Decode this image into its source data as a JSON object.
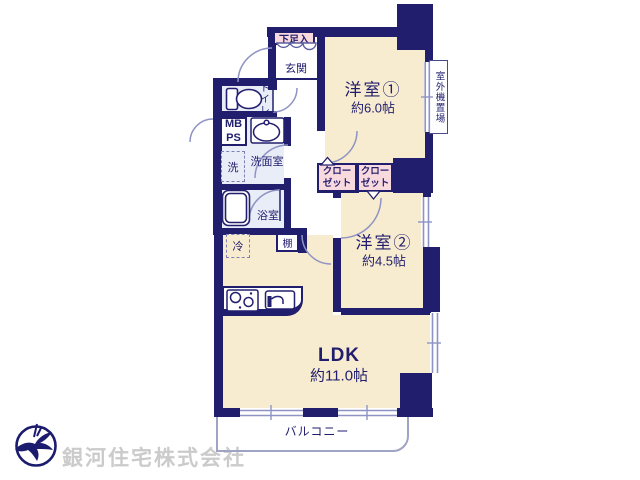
{
  "plan": {
    "room1": {
      "name": "洋室①",
      "area": "約6.0帖"
    },
    "room2": {
      "name": "洋室②",
      "area": "約4.5帖"
    },
    "ldk": {
      "name": "LDK",
      "area": "約11.0帖"
    },
    "entrance": "玄関",
    "shoe_storage": "下足入",
    "toilet": "トイレ",
    "meter_box": "MB",
    "pipe_shaft": "PS",
    "washroom": "洗面室",
    "washer": "洗",
    "bathroom": "浴室",
    "closet": {
      "line1": "クロー",
      "line2": "ゼット"
    },
    "fridge": "冷",
    "shelf": "棚",
    "balcony": "バルコニー",
    "outdoor_unit": "室外機置場"
  },
  "watermark": {
    "company": "銀河住宅株式会社"
  },
  "colors": {
    "wall": "#211e6e",
    "floor": "#f8ecd0",
    "wet_area": "#e9edf7",
    "closet_pink": "#f8d9de",
    "door_line": "#8f93c4",
    "balcony_line": "#a0a3c4",
    "watermark_gray": "#cbcbcb"
  }
}
